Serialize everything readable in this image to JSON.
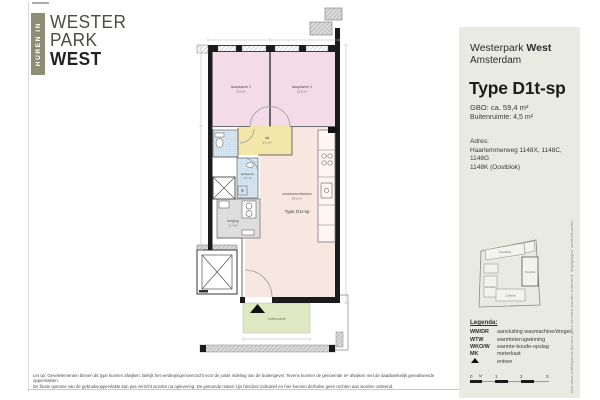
{
  "logo": {
    "vertical_label": "HUREN IN",
    "line1": "WESTER",
    "line2": "PARK",
    "line3": "WEST"
  },
  "panel": {
    "project_name": "Westerpark ",
    "project_name_bold": "West",
    "city": "Amsterdam",
    "type_title": "Type D1t-sp",
    "gbo": "GBO: ca. 59,4 m²",
    "buitenruimte": "Buitenruimte: 4,5 m²",
    "adres_label": "Adres:",
    "adres_line1": "Haarlemmerweg 1148X, 1148C, 1148G",
    "adres_line2": "1148K  (Oostblok)",
    "site_map": {
      "blocks": {
        "north": "Noordblok",
        "east": "Oostblok",
        "south": "Zuidblok",
        "west": "Westblok"
      }
    },
    "legend": {
      "title": "Legenda:",
      "items": [
        {
          "key": "WM/DR",
          "label": "aansluiting wasmachine/droger"
        },
        {
          "key": "WTW",
          "label": "warmteterugwinning"
        },
        {
          "key": "WKO/W",
          "label": "warmte-koude-opslag"
        },
        {
          "key": "MK",
          "label": "meterkast"
        },
        {
          "key": "",
          "label": "entree",
          "icon": "triangle-up"
        }
      ]
    },
    "scale": {
      "labels": [
        "0",
        "M",
        "1",
        "2",
        "3"
      ]
    },
    "side_note": "Aan deze plattegrond kunnen geen rechten worden ontleend. Wijzigingen voorbehouden."
  },
  "plan": {
    "type_label": "Type D1t-sp",
    "rooms": {
      "slaapkamer2": {
        "name": "slaapkamer 2",
        "area": "9,5 m²"
      },
      "slaapkamer1": {
        "name": "slaapkamer 1",
        "area": "12,5 m²"
      },
      "hal": {
        "name": "hal",
        "area": "3,1 m²"
      },
      "badkamer": {
        "name": "badkamer",
        "area": "4,7 m²"
      },
      "berging": {
        "name": "berging",
        "area": "2,7 m²"
      },
      "woonkamer": {
        "name": "woonkamer/keuken",
        "area": "24,0 m²"
      },
      "buitenruimte": {
        "name": "buitenruimte"
      }
    },
    "colors": {
      "bedroom": "#f3dbe7",
      "living": "#f8e7e0",
      "hall": "#f3e6a9",
      "wet": "#dce9f3",
      "storage": "#dedede",
      "outdoor": "#dfe8c2"
    }
  },
  "footer": {
    "line1": "Let op: Gevelelementen binnen dit type kunnen afwijken. Bekijk het verdiepingenoverzicht voor de juiste indeling van de buitengevel. Tevens kunnen de genoemde m² afwijken met de daadwerkelijk gerealiseerde oppervlakten.",
    "line2": "De finale opname van de gebruiksoppervlakte kan pas verricht worden na oplevering. De getoonde maten zijn hierdoor indicatief en hier kunnen derhalve geen rechten aan worden ontleend."
  }
}
